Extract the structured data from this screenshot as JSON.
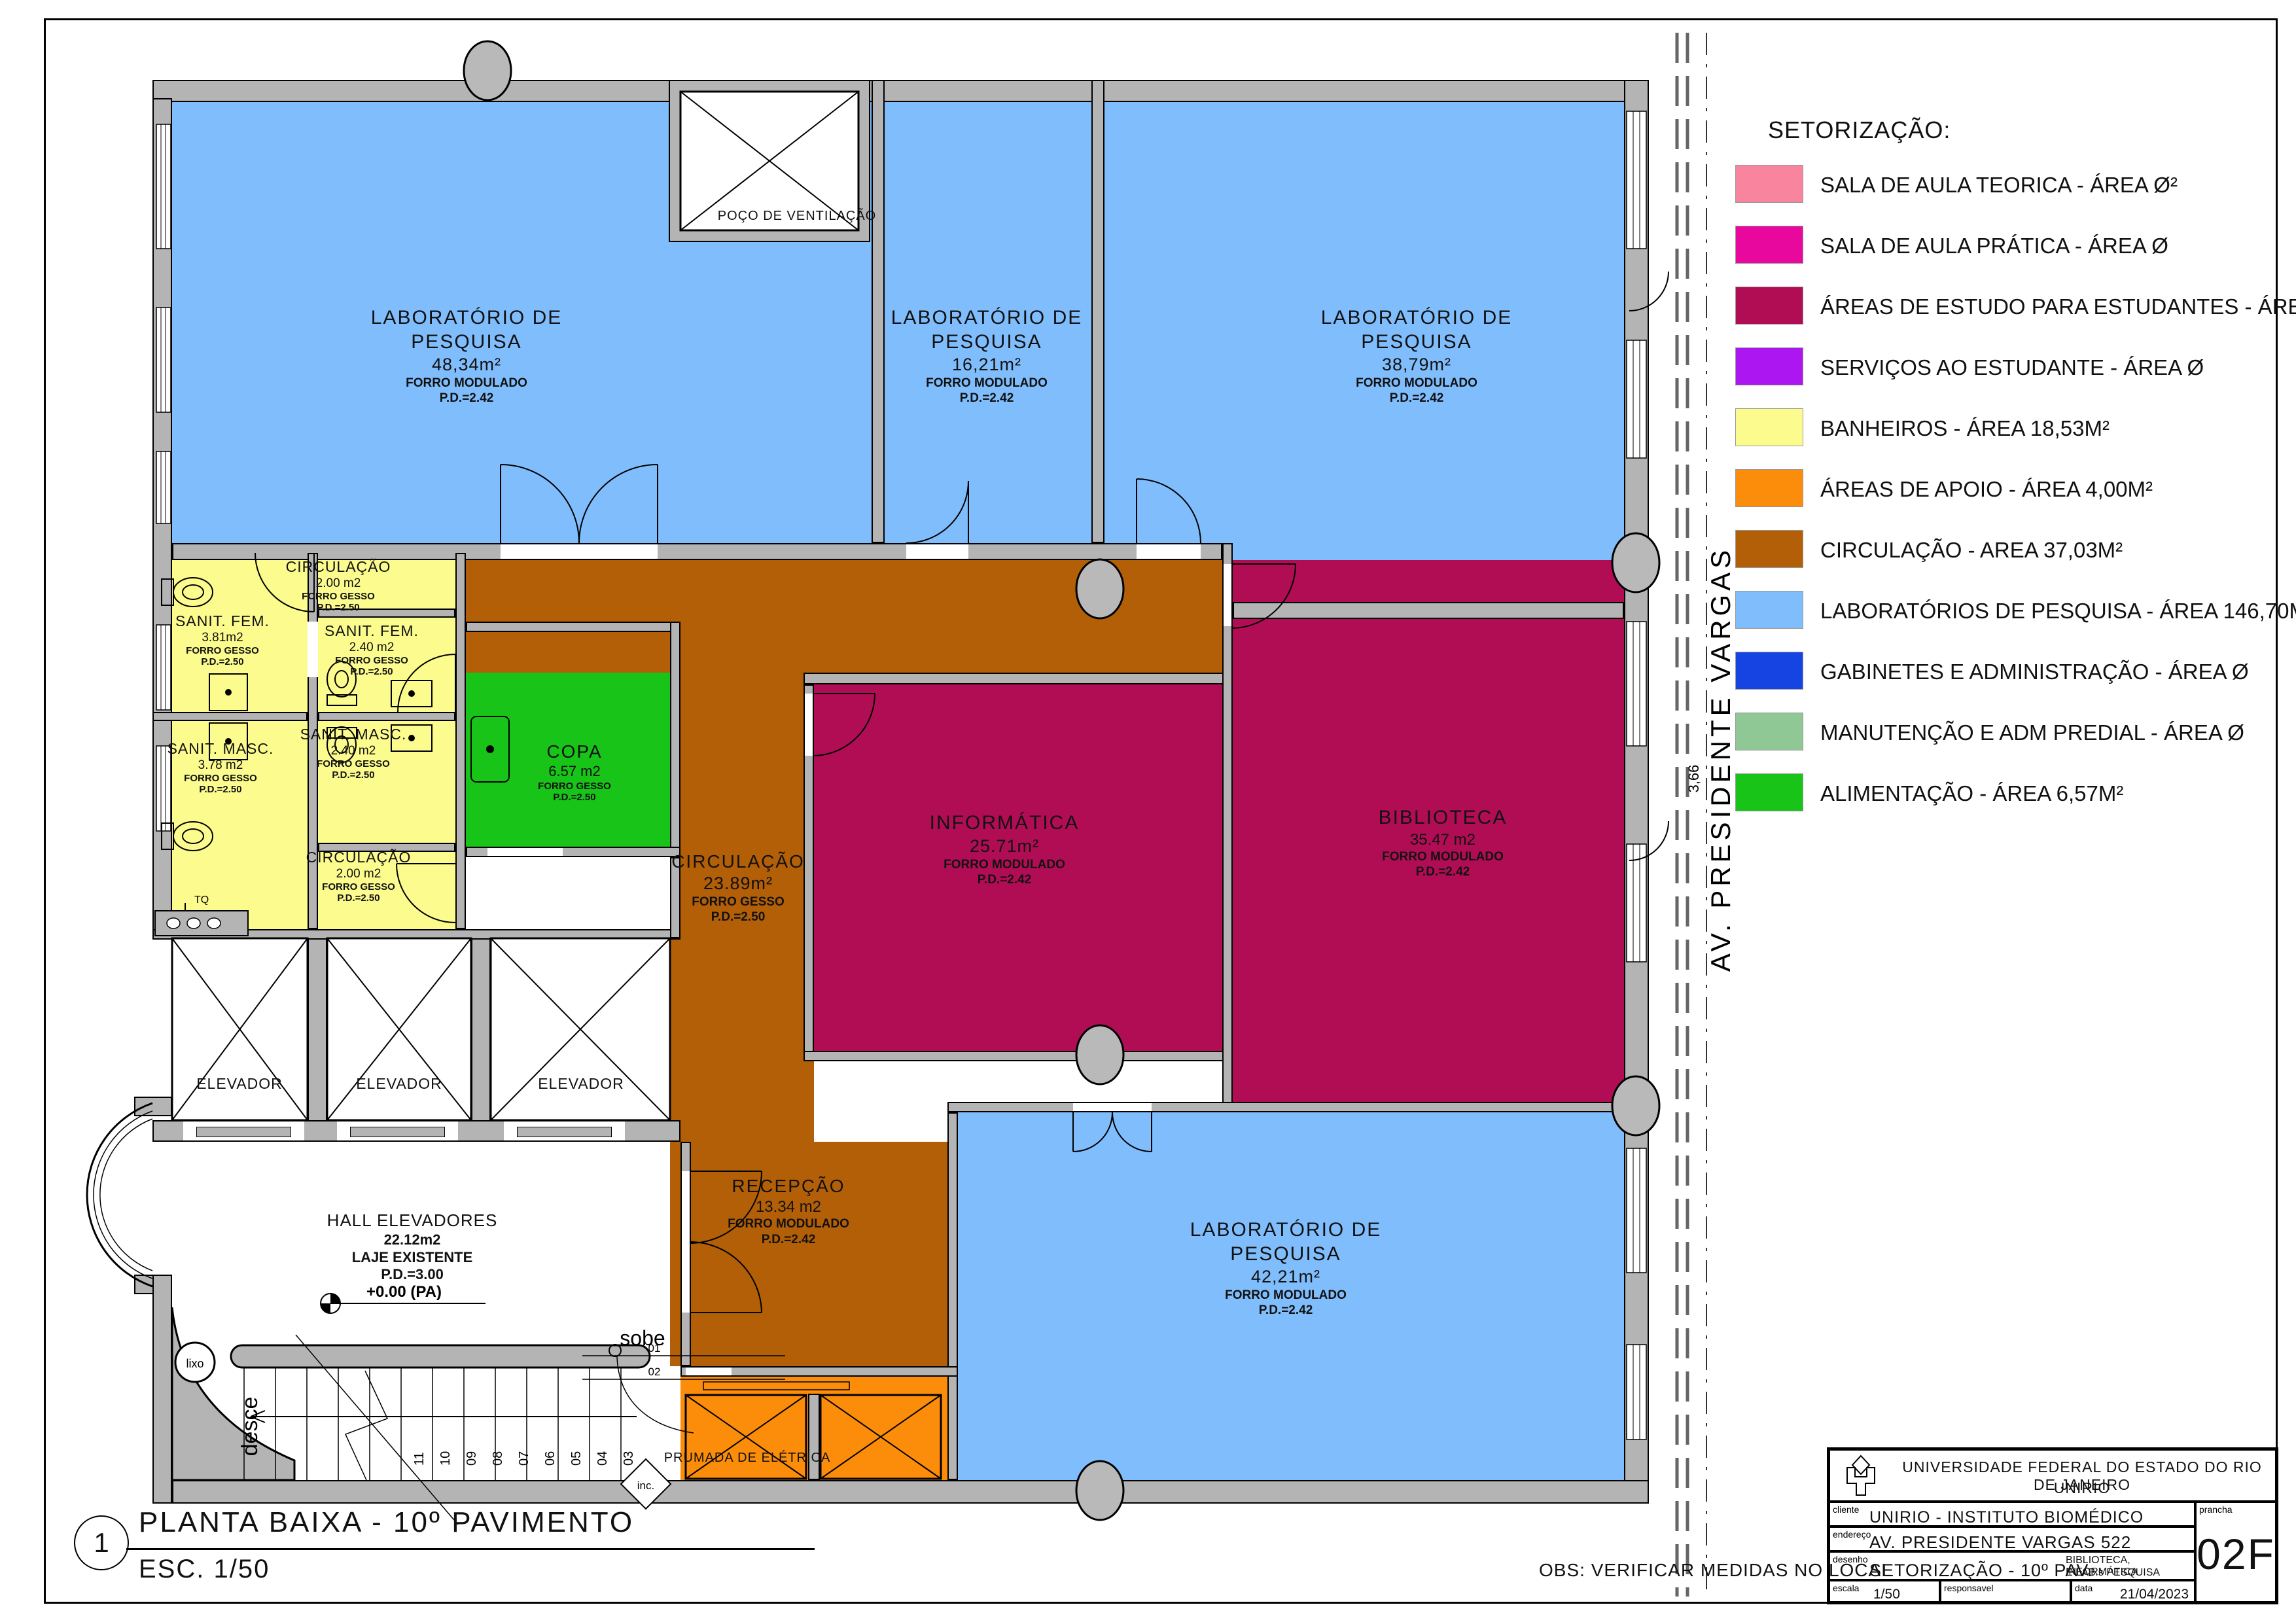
{
  "legend": {
    "title": "SETORIZAÇÃO:",
    "items": [
      {
        "label": "SALA DE AULA TEORICA - ÁREA Ø²",
        "color": "#F8849E"
      },
      {
        "label": "SALA DE AULA PRÁTICA - ÁREA Ø",
        "color": "#E8089E"
      },
      {
        "label": "ÁREAS DE ESTUDO PARA ESTUDANTES - ÁREA 61,66M²",
        "color": "#B10D55"
      },
      {
        "label": "SERVIÇOS AO ESTUDANTE - ÁREA Ø",
        "color": "#AC16F0"
      },
      {
        "label": "BANHEIROS  - ÁREA 18,53M²",
        "color": "#FBFB8E"
      },
      {
        "label": "ÁREAS DE APOIO - ÁREA 4,00M²",
        "color": "#FB8D0A"
      },
      {
        "label": "CIRCULAÇÃO  - AREA 37,03M²",
        "color": "#B25F07"
      },
      {
        "label": "LABORATÓRIOS DE PESQUISA - ÁREA 146,70M²",
        "color": "#80BDFC"
      },
      {
        "label": "GABINETES E ADMINISTRAÇÃO - ÁREA Ø",
        "color": "#1544E3"
      },
      {
        "label": "MANUTENÇÃO E ADM PREDIAL - ÁREA Ø",
        "color": "#8FC795"
      },
      {
        "label": "ALIMENTAÇÃO - ÁREA 6,57M²",
        "color": "#17C417"
      }
    ]
  },
  "plan": {
    "rooms": {
      "lab1": {
        "l1": "LABORATÓRIO DE",
        "l2": "PESQUISA",
        "area": "48,34m²",
        "c": "FORRO MODULADO",
        "pd": "P.D.=2.42"
      },
      "lab2": {
        "l1": "LABORATÓRIO DE",
        "l2": "PESQUISA",
        "area": "16,21m²",
        "c": "FORRO MODULADO",
        "pd": "P.D.=2.42"
      },
      "lab3": {
        "l1": "LABORATÓRIO DE",
        "l2": "PESQUISA",
        "area": "38,79m²",
        "c": "FORRO MODULADO",
        "pd": "P.D.=2.42"
      },
      "lab4": {
        "l1": "LABORATÓRIO DE",
        "l2": "PESQUISA",
        "area": "42,21m²",
        "c": "FORRO MODULADO",
        "pd": "P.D.=2.42"
      },
      "informatica": {
        "l1": "INFORMÁTICA",
        "area": "25.71m²",
        "c": "FORRO MODULADO",
        "pd": "P.D.=2.42"
      },
      "biblioteca": {
        "l1": "BIBLIOTECA",
        "area": "35.47 m2",
        "c": "FORRO MODULADO",
        "pd": "P.D.=2.42"
      },
      "recepcao": {
        "l1": "RECEPÇÃO",
        "area": "13.34 m2",
        "c": "FORRO MODULADO",
        "pd": "P.D.=2.42"
      },
      "circulacao": {
        "l1": "CIRCULAÇÃO",
        "area": "23.89m²",
        "c": "FORRO GESSO",
        "pd": "P.D.=2.50"
      },
      "copa": {
        "l1": "COPA",
        "area": "6.57 m2",
        "c": "FORRO GESSO",
        "pd": "P.D.=2.50"
      },
      "sanit_fem_1": {
        "l1": "SANIT.  FEM.",
        "area": "3.81m2",
        "c": "FORRO GESSO",
        "pd": "P.D.=2.50"
      },
      "sanit_fem_2": {
        "l1": "SANIT.  FEM.",
        "area": "2.40 m2",
        "c": "FORRO GESSO",
        "pd": "P.D.=2.50"
      },
      "sanit_masc_1": {
        "l1": "SANIT.  MASC.",
        "area": "3.78 m2",
        "c": "FORRO GESSO",
        "pd": "P.D.=2.50"
      },
      "sanit_masc_2": {
        "l1": "SANIT.  MASC.",
        "area": "2.40 m2",
        "c": "FORRO GESSO",
        "pd": "P.D.=2.50"
      },
      "circ_top": {
        "l1": "CIRCULAÇÃO",
        "area": "2.00 m2",
        "c": "FORRO GESSO",
        "pd": "P.D.=2.50"
      },
      "circ_bottom": {
        "l1": "CIRCULAÇÃO",
        "area": "2.00 m2",
        "c": "FORRO GESSO",
        "pd": "P.D.=2.50"
      },
      "hall": {
        "l1": "HALL  ELEVADORES",
        "area": "22.12m2",
        "c": "LAJE  EXISTENTE",
        "pd": "P.D.=3.00",
        "level": "+0.00  (PA)"
      },
      "elevador": "ELEVADOR",
      "poco": "POÇO  DE  VENTILAÇÃO",
      "prumada": "PRUMADA DE ELÉTRICA"
    },
    "annotations": {
      "street": "AV.  PRESIDENTE  VARGAS",
      "dim": "3,66",
      "sobe": "sobe",
      "desce": "desce",
      "inc": "inc.",
      "lixo": "lixo",
      "tq": "TQ",
      "step01": "01",
      "step02": "02",
      "stair_numbers": [
        "11",
        "10",
        "09",
        "08",
        "07",
        "06",
        "05",
        "04",
        "03"
      ]
    }
  },
  "title_block": {
    "org1": "UNIVERSIDADE FEDERAL DO ESTADO DO RIO DE JANEIRO",
    "org2": "UNIRIO",
    "cliente_label": "cliente",
    "cliente": "UNIRIO - INSTITUTO BIOMÉDICO",
    "endereco_label": "endereço",
    "endereco": "AV. PRESIDENTE VARGAS 522",
    "desenho_label": "desenho",
    "desenho": "SETORIZAÇÃO - 10º PAV.",
    "desenho_extra1": "BIBLIOTECA, INFORMÁTICA",
    "desenho_extra2": "E LAB.s  PESQUISA",
    "escala_label": "escala",
    "escala": "1/50",
    "responsavel_label": "responsavel",
    "data_label": "data",
    "data": "21/04/2023",
    "prancha_label": "prancha",
    "prancha": "02F"
  },
  "footer": {
    "num": "1",
    "title": "PLANTA BAIXA - 10º PAVIMENTO",
    "esc": "ESC. 1/50",
    "obs": "OBS: VERIFICAR MEDIDAS NO LOCAL"
  }
}
